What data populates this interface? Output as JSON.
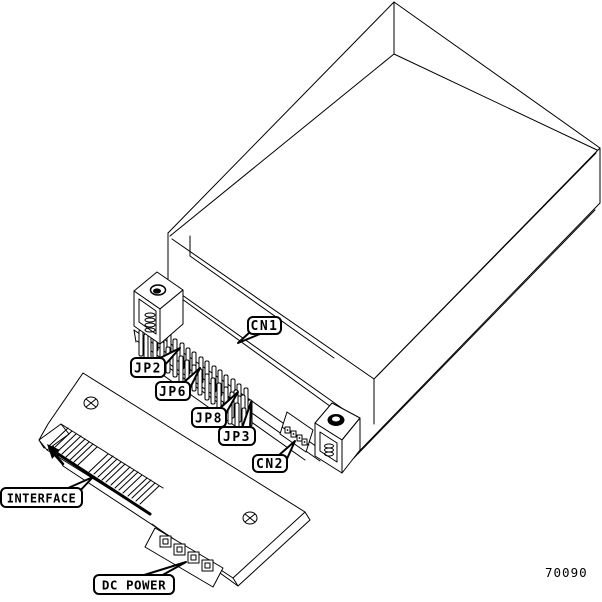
{
  "figure": {
    "description": "Exploded isometric line drawing of drive enclosure and interface board",
    "part_number": "70090",
    "line_color": "#000000",
    "background_color": "#ffffff",
    "callouts": {
      "cn1": "CN1",
      "jp2": "JP2",
      "jp6": "JP6",
      "jp8": "JP8",
      "jp3": "JP3",
      "cn2": "CN2",
      "interface": "INTERFACE",
      "dc_power": "DC POWER"
    }
  }
}
